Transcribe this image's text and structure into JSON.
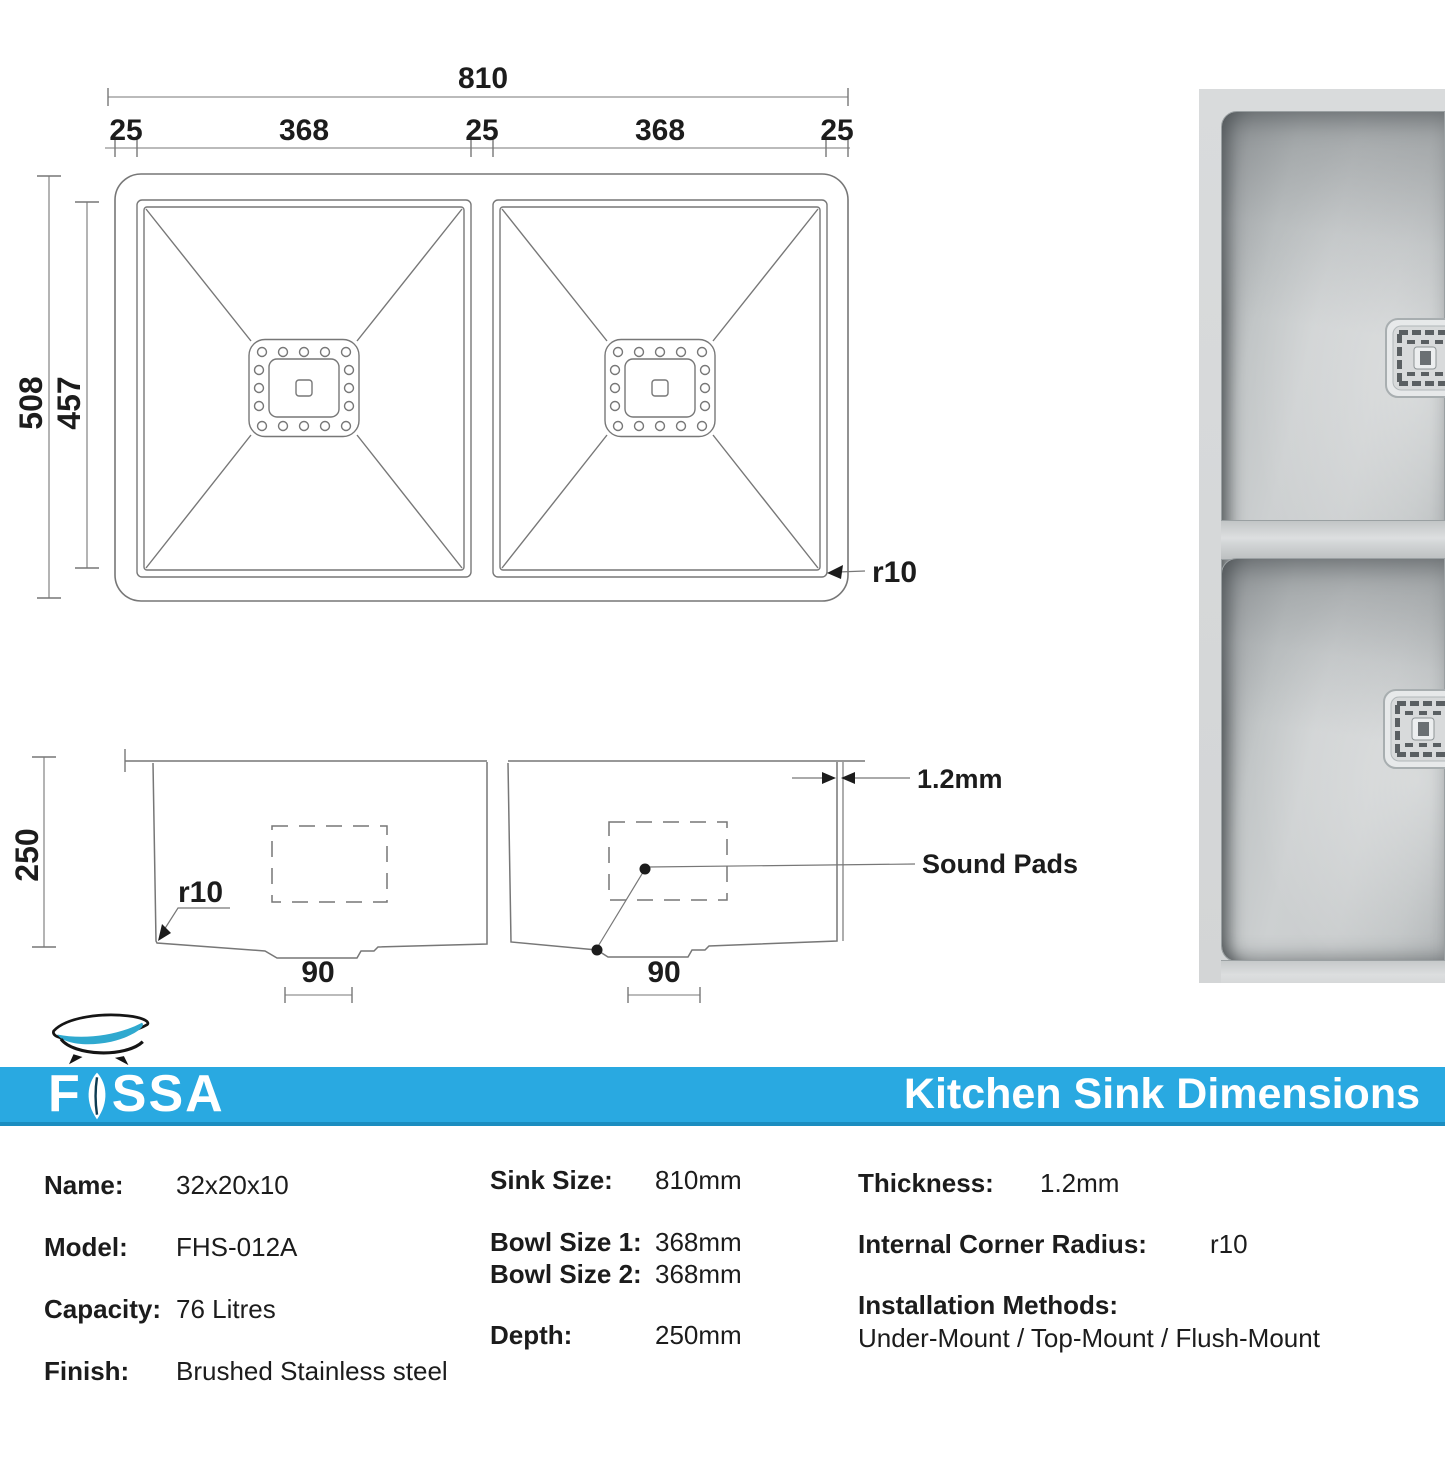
{
  "colors": {
    "banner_blue": "#29a9e1",
    "banner_edge": "#1b8dc0",
    "logo_cyan": "#2fa9cf",
    "line_gray": "#777777"
  },
  "top_view": {
    "dim_total": "810",
    "dim_segments": [
      "25",
      "368",
      "25",
      "368",
      "25"
    ],
    "dim_outer_height": "508",
    "dim_inner_height": "457",
    "corner_radius": "r10"
  },
  "side_view": {
    "dim_depth": "250",
    "dim_thickness": "1.2mm",
    "sound_pads": "Sound Pads",
    "corner_radius": "r10",
    "dim_drain_left": "90",
    "dim_drain_right": "90"
  },
  "photo": {
    "watermark": "FOSSA"
  },
  "banner": {
    "brand_f": "F",
    "brand_rest": "SSA",
    "title": "Kitchen Sink Dimensions"
  },
  "specs": {
    "col1": [
      {
        "label": "Name:",
        "value": "32x20x10"
      },
      {
        "label": "Model:",
        "value": "FHS-012A"
      },
      {
        "label": "Capacity:",
        "value": "76 Litres"
      },
      {
        "label": "Finish:",
        "value": "Brushed Stainless steel"
      }
    ],
    "col2": [
      {
        "label": "Sink Size:",
        "value": "810mm"
      },
      {
        "label": "Bowl Size 1:",
        "value": "368mm"
      },
      {
        "label": "Bowl Size 2:",
        "value": "368mm"
      },
      {
        "label": "Depth:",
        "value": "250mm"
      }
    ],
    "col3": [
      {
        "label": "Thickness:",
        "value": "1.2mm"
      },
      {
        "label": "Internal Corner Radius:",
        "value": "r10"
      },
      {
        "label": "Installation Methods:",
        "value": "Under-Mount / Top-Mount / Flush-Mount"
      }
    ]
  }
}
